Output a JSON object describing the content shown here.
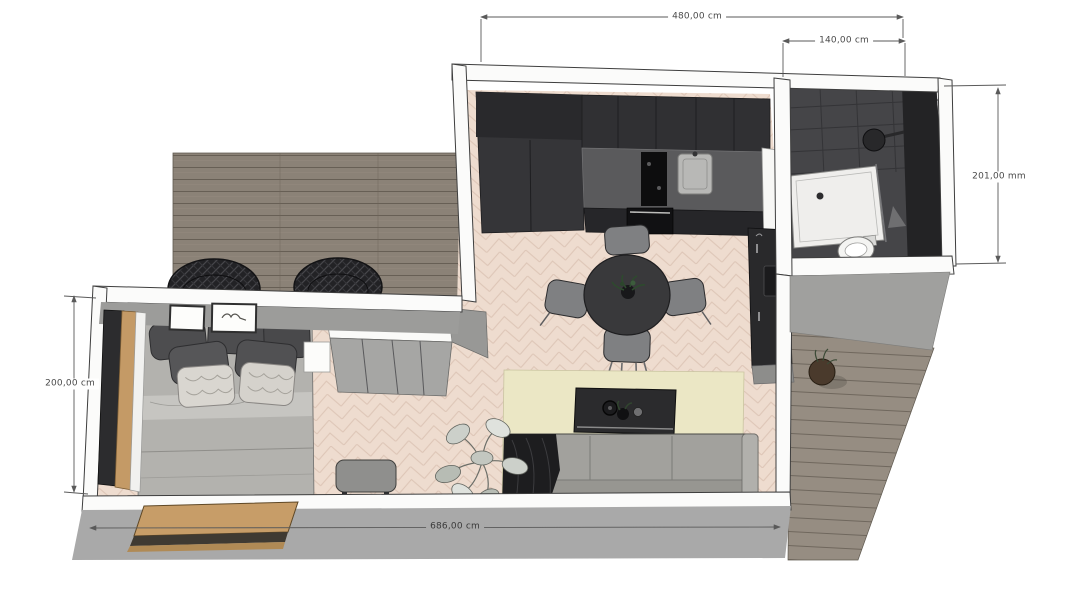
{
  "plan": {
    "dimensions": {
      "top_width": "480,00 cm",
      "bath_width": "140,00 cm",
      "bath_depth": "201,00 mm",
      "bedroom_depth": "200,00 cm",
      "total_width": "686,00 cm"
    },
    "colors": {
      "background": "#ffffff",
      "interior_floor": "#eedccf",
      "floor_pattern_line": "#ddc5b6",
      "deck_wood": "#8b8277",
      "deck_wood_right": "#968d82",
      "wall_white": "#fbfbfa",
      "wall_gray_face": "#a9a9a9",
      "kitchen_cabinets": "#303033",
      "countertop": "#5a5a5c",
      "bathroom_dark": "#454548",
      "rug": "#ebe7c5",
      "sofa": "#a2a19d",
      "wood_accent": "#c49a66",
      "dimension_line": "#5a5a5a"
    }
  }
}
